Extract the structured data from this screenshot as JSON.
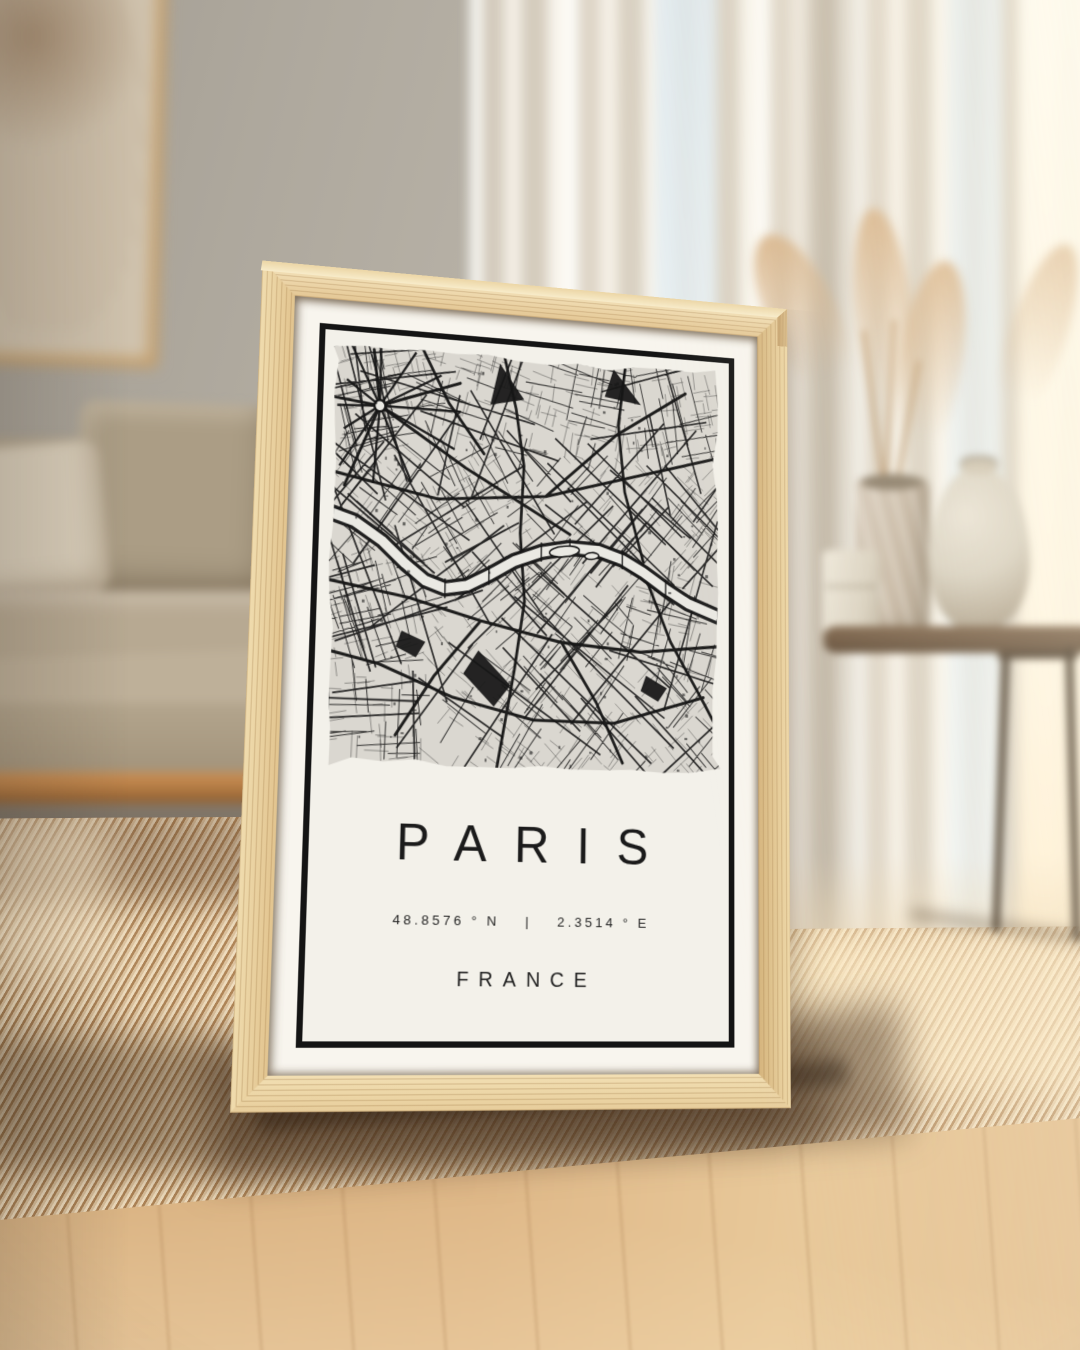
{
  "poster": {
    "title": "PARIS",
    "coordinates": {
      "lat": "48.8576 ° N",
      "separator": "|",
      "lon": "2.3514 ° E"
    },
    "country": "FRANCE",
    "colors": {
      "ink": "#161616",
      "paper": "#f3f1ea",
      "map_bg": "#dad7d0",
      "river": "#eae9e3",
      "frame_wood": "#e6cda0",
      "mat": "#f8f5ee",
      "border": "#141414"
    },
    "map": {
      "seed": 20,
      "width": 440,
      "height": 430,
      "hub": [
        52,
        66
      ],
      "hub_spokes": 12,
      "seine": [
        [
          -6,
          176
        ],
        [
          28,
          186
        ],
        [
          58,
          204
        ],
        [
          84,
          226
        ],
        [
          106,
          242
        ],
        [
          128,
          249
        ],
        [
          152,
          245
        ],
        [
          176,
          233
        ],
        [
          204,
          217
        ],
        [
          234,
          206
        ],
        [
          266,
          200
        ],
        [
          298,
          201
        ],
        [
          326,
          209
        ],
        [
          350,
          221
        ],
        [
          376,
          237
        ],
        [
          402,
          251
        ],
        [
          446,
          266
        ]
      ],
      "islands": [
        [
          260,
          204,
          17,
          5.5,
          -8
        ],
        [
          291,
          207,
          8,
          3.5,
          -6
        ]
      ],
      "majors": [
        [
          [
            0,
            136
          ],
          [
            118,
            158
          ],
          [
            238,
            148
          ],
          [
            358,
            116
          ],
          [
            440,
            94
          ]
        ],
        [
          [
            52,
            66
          ],
          [
            148,
            124
          ],
          [
            232,
            168
          ],
          [
            266,
            186
          ]
        ],
        [
          [
            0,
            246
          ],
          [
            88,
            260
          ],
          [
            168,
            280
          ],
          [
            258,
            298
          ],
          [
            348,
            304
          ],
          [
            440,
            294
          ]
        ],
        [
          [
            188,
            0
          ],
          [
            203,
            58
          ],
          [
            213,
            118
          ],
          [
            210,
            188
          ]
        ],
        [
          [
            210,
            188
          ],
          [
            216,
            258
          ],
          [
            206,
            328
          ],
          [
            188,
            430
          ]
        ],
        [
          [
            328,
            0
          ],
          [
            320,
            68
          ],
          [
            328,
            138
          ],
          [
            350,
            210
          ]
        ],
        [
          [
            350,
            220
          ],
          [
            382,
            292
          ],
          [
            422,
            356
          ],
          [
            440,
            386
          ]
        ],
        [
          [
            58,
            328
          ],
          [
            138,
            358
          ],
          [
            228,
            378
          ],
          [
            318,
            378
          ],
          [
            420,
            348
          ]
        ],
        [
          [
            0,
            316
          ],
          [
            58,
            328
          ]
        ],
        [
          [
            96,
            0
          ],
          [
            128,
            58
          ],
          [
            168,
            108
          ]
        ],
        [
          [
            238,
            148
          ],
          [
            318,
            78
          ],
          [
            398,
            28
          ]
        ],
        [
          [
            168,
            280
          ],
          [
            118,
            338
          ],
          [
            78,
            398
          ]
        ],
        [
          [
            258,
            298
          ],
          [
            298,
            358
          ],
          [
            328,
            418
          ]
        ],
        [
          [
            0,
            60
          ],
          [
            52,
            66
          ]
        ],
        [
          [
            52,
            66
          ],
          [
            44,
            8
          ]
        ],
        [
          [
            52,
            66
          ],
          [
            16,
            150
          ]
        ],
        [
          [
            52,
            66
          ],
          [
            140,
            36
          ]
        ]
      ],
      "bridges": [
        [
          128,
          249
        ],
        [
          176,
          233
        ],
        [
          234,
          206
        ],
        [
          266,
          200
        ],
        [
          326,
          209
        ],
        [
          376,
          237
        ]
      ],
      "blobs": [
        [
          [
            184,
            12
          ],
          [
            212,
            48
          ],
          [
            174,
            56
          ]
        ],
        [
          [
            314,
            8
          ],
          [
            346,
            44
          ],
          [
            304,
            38
          ]
        ],
        [
          [
            166,
            310
          ],
          [
            202,
            344
          ],
          [
            184,
            366
          ],
          [
            150,
            334
          ]
        ],
        [
          [
            82,
            294
          ],
          [
            108,
            304
          ],
          [
            98,
            320
          ],
          [
            76,
            310
          ]
        ],
        [
          [
            354,
            328
          ],
          [
            378,
            340
          ],
          [
            368,
            354
          ],
          [
            348,
            344
          ]
        ]
      ]
    }
  }
}
